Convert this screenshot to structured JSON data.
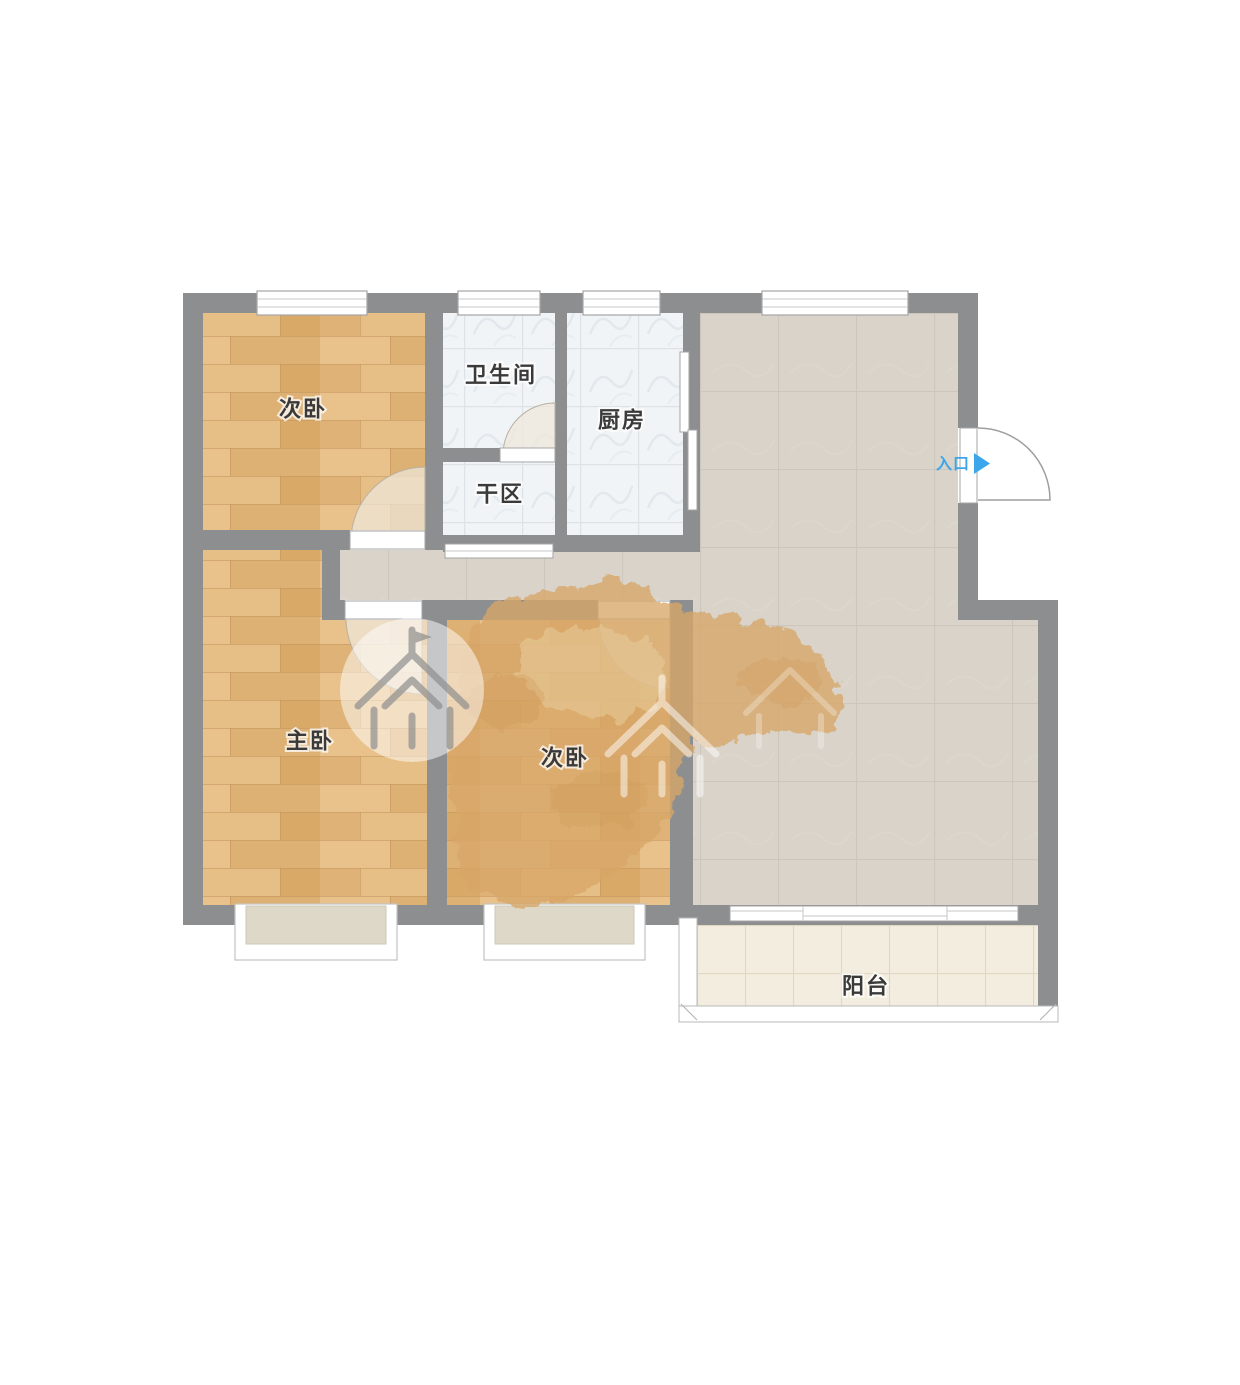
{
  "rooms": [
    {
      "id": "bedroom-top-left",
      "label": "次卧"
    },
    {
      "id": "bathroom",
      "label": "卫生间"
    },
    {
      "id": "kitchen",
      "label": "厨房"
    },
    {
      "id": "dry-area",
      "label": "干区"
    },
    {
      "id": "master-bedroom",
      "label": "主卧"
    },
    {
      "id": "bedroom-middle",
      "label": "次卧"
    },
    {
      "id": "balcony",
      "label": "阳台"
    }
  ],
  "entrance": {
    "label": "入口",
    "arrow": "▶"
  },
  "colors": {
    "wall": "#8d8e90",
    "wood_base": "#e3b87c",
    "marble_base": "#f1f4f6",
    "living_base": "#d9d3ca",
    "balcony_base": "#f2edde",
    "accent_blue": "#3ba6ea",
    "label_text": "#3a3a3a"
  }
}
